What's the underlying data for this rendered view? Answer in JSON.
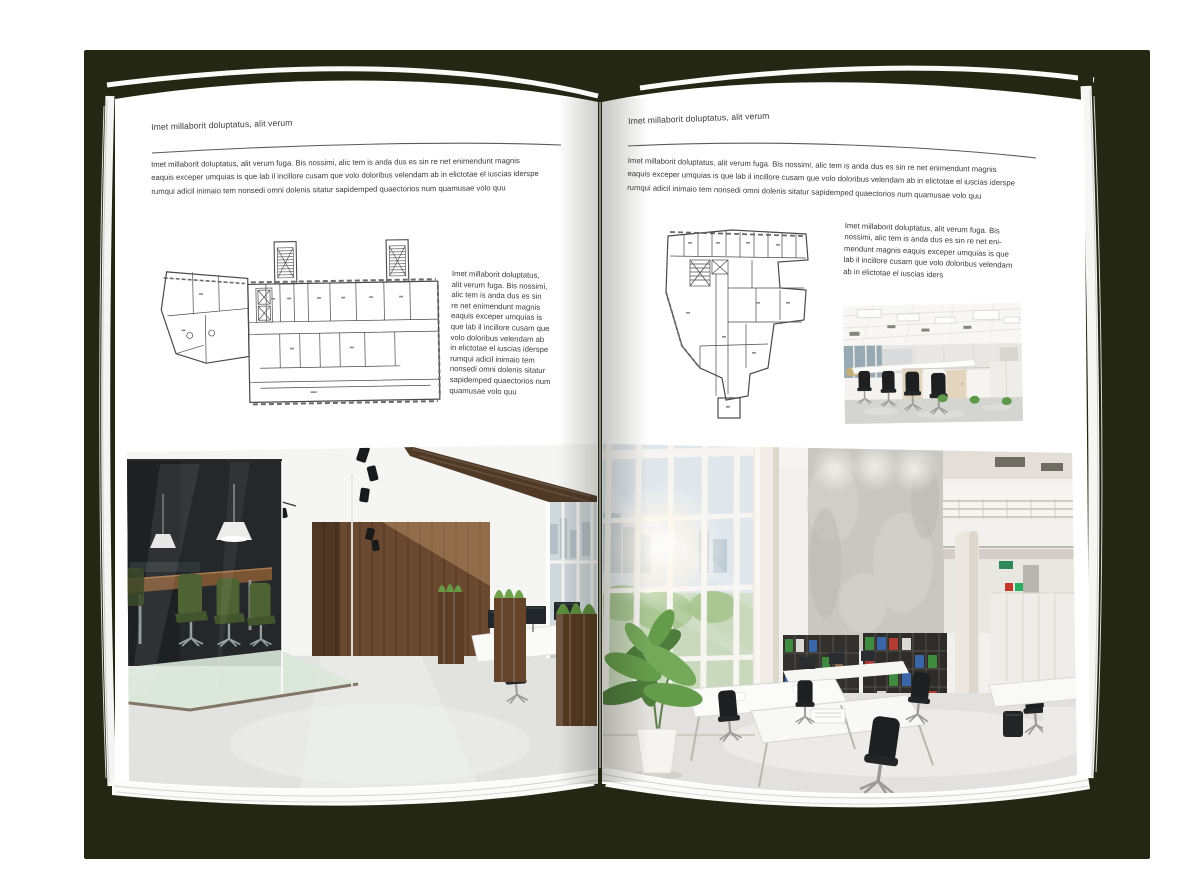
{
  "left_page": {
    "header": "Imet millaborit doluptatus, alit verum",
    "body_lines": [
      "Imet millaborit doluptatus, alit verum fuga. Bis nossimi, alic tem is anda dus es sin re net enimendunt magnis",
      "eaquis exceper umquias is que lab il incillore cusam que volo doloribus velendam ab in elictotae el iuscias iderspe",
      "rumqui adicil inimaio tem nonsedi omni dolenis sitatur sapidemped quaectorios num quamusae volo quu"
    ],
    "caption_lines": [
      "Imet millaborit doluptatus,",
      "alit verum fuga. Bis nossimi,",
      "alic tem is anda dus es sin",
      "re net enimendunt magnis",
      "eaquis exceper umquias is",
      "que lab il incillore cusam que",
      "volo doloribus velendam ab",
      "in elictotae el iuscias iderspe",
      "rumqui adicil inimaio tem",
      "nonsedi omni dolenis sitatur",
      "sapidemped quaectorios num",
      "quamusae volo quu"
    ]
  },
  "right_page": {
    "header": "Imet millaborit doluptatus, alit verum",
    "body_lines": [
      "Imet millaborit doluptatus, alit verum fuga. Bis nossimi, alic tem is anda dus es sin re net enimendunt magnis",
      "eaquis exceper umquias is que lab il incillore cusam que volo doloribus velendam ab in elictotae el iuscias iderspe",
      "rumqui adicil inimaio tem nonsedi omni dolenis sitatur sapidemped quaectorios num quamusae volo quu"
    ],
    "caption_lines": [
      "Imet millaborit doluptatus, alit verum fuga. Bis",
      "nossimi, alic tem is anda dus es sin re net eni-",
      "mendunt magnis eaquis exceper umquias is que",
      "lab il incillore cusam que volo doloribus velendam",
      "ab in elictotae el iuscias iders"
    ]
  },
  "colors": {
    "backdrop_shadow": "#242713",
    "page": "#ffffff",
    "text": "#3a3a3a",
    "rule": "#5b5b5b",
    "plan_lines": "#4a4a4a"
  }
}
